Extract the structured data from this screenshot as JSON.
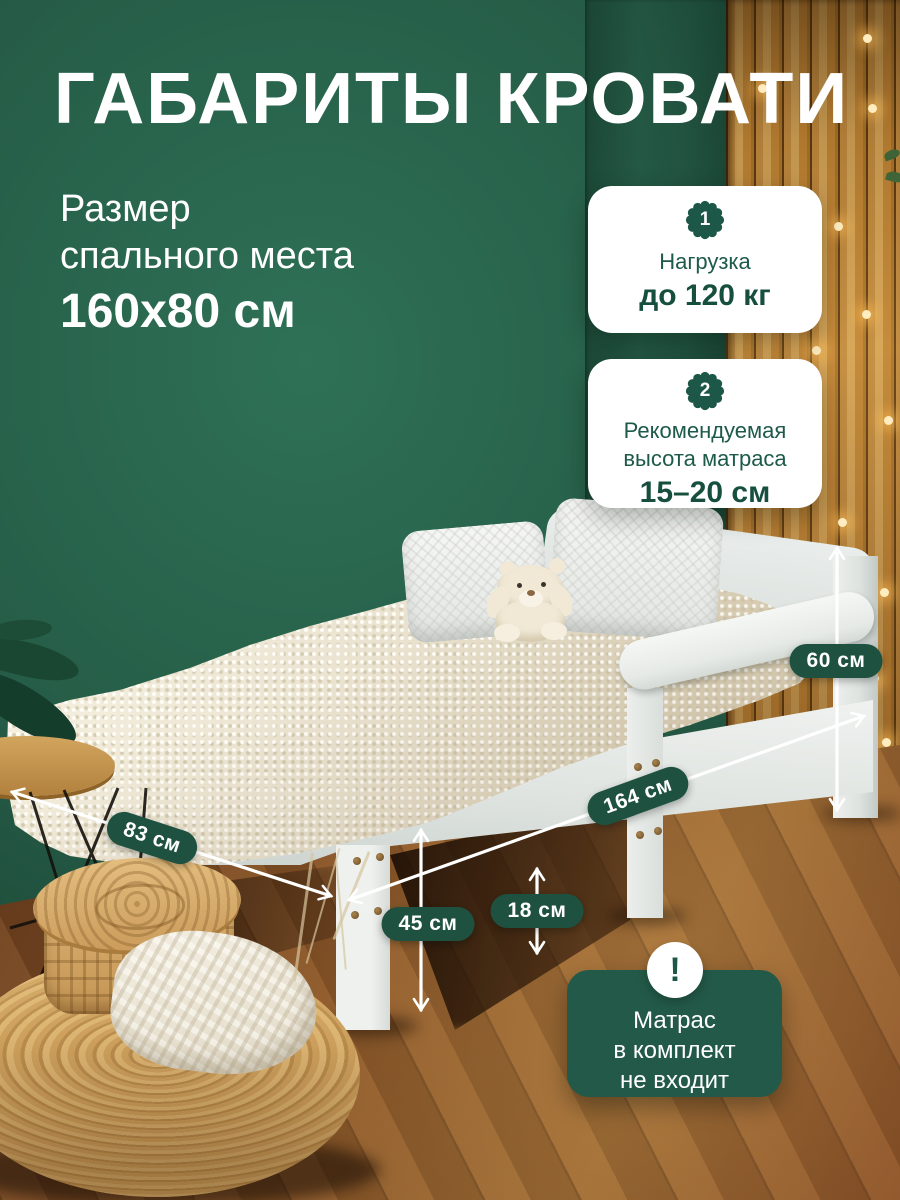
{
  "title": "ГАБАРИТЫ КРОВАТИ",
  "sleeping_area": {
    "line1": "Размер",
    "line2": "спального места",
    "size": "160x80 см"
  },
  "info_cards": [
    {
      "number": "1",
      "line1": "Нагрузка",
      "bold": "до 120 кг"
    },
    {
      "number": "2",
      "line1": "Рекомендуемая",
      "line2": "высота матраса",
      "bold": "15–20 см"
    }
  ],
  "dimensions": {
    "back_height": "60 см",
    "length": "164 см",
    "width": "83 см",
    "side_height": "45 см",
    "under_clearance": "18 см"
  },
  "note": {
    "icon": "!",
    "line1": "Матрас",
    "line2": "в комплект",
    "line3": "не входит"
  },
  "colors": {
    "accent_green": "#1e5140",
    "card_text_green": "#1d5a49",
    "wall_green": "#255b46",
    "wood_wall": "#c18a3e",
    "floor_brown": "#8a5628",
    "bed_white": "#eef0ee",
    "blanket_cream": "#eae2cf"
  }
}
